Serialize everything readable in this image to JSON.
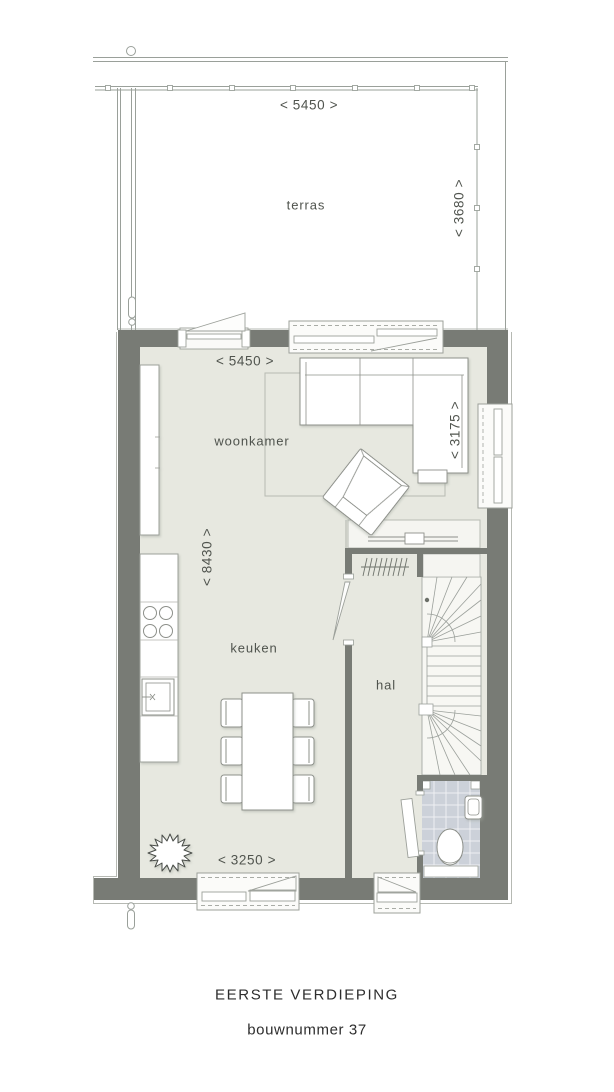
{
  "plan": {
    "type": "floorplan",
    "rooms": {
      "terras": "terras",
      "woonkamer": "woonkamer",
      "keuken": "keuken",
      "hal": "hal"
    },
    "dimensions": {
      "terras_width": "< 5450 >",
      "terras_depth": "< 3680 >",
      "woonkamer_width": "< 5450 >",
      "sofa_zone_depth": "< 3175 >",
      "floor_depth": "< 8430 >",
      "keuken_width": "< 3250 >"
    },
    "footer": {
      "floor_title": "EERSTE VERDIEPING",
      "build_number": "bouwnummer 37"
    },
    "colors": {
      "wall": "#787b75",
      "floor": "#e7e8e0",
      "terrace_floor": "#ffffff",
      "wc_tile": "#ccd1d9",
      "linework": "#9ca09a",
      "text": "#4f534d",
      "title_text": "#2d2d2d"
    }
  }
}
